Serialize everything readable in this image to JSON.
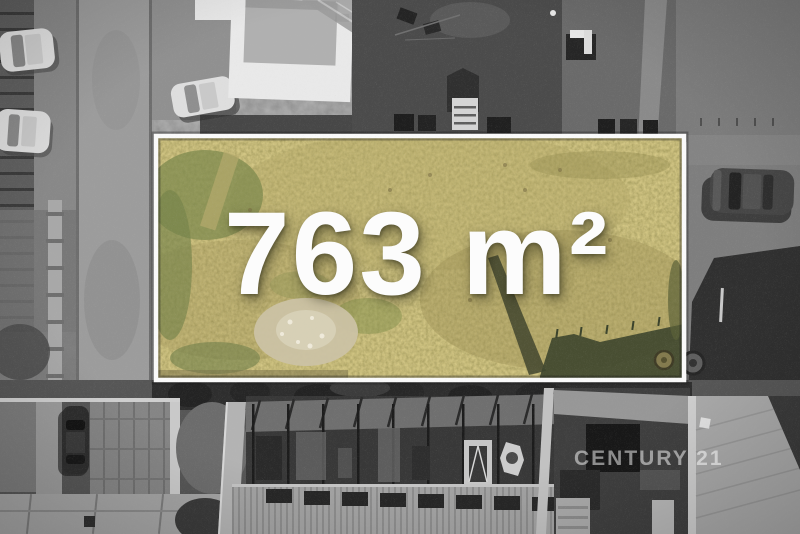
{
  "overlay": {
    "area_label": "763 m²",
    "watermark": "CENTURY 21"
  },
  "photo": {
    "colors": {
      "plot_grass": "#a2955a",
      "plot_border": "#fafafa",
      "label_text": "#fcfcfc",
      "surroundings": "grayscale"
    }
  }
}
